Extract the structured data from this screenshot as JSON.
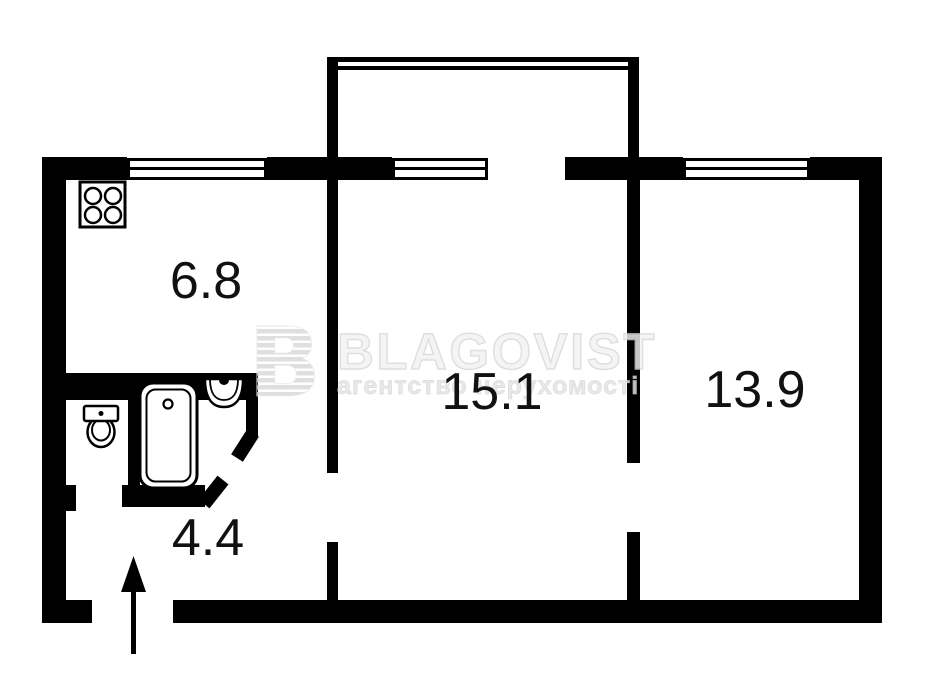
{
  "plan": {
    "background_color": "#ffffff",
    "wall_color": "#000000",
    "label_color": "#111111",
    "rooms": [
      {
        "name": "kitchen",
        "area_label": "6.8"
      },
      {
        "name": "living-room",
        "area_label": "15.1"
      },
      {
        "name": "bedroom",
        "area_label": "13.9"
      },
      {
        "name": "hallway",
        "area_label": "4.4"
      }
    ],
    "fixtures": [
      {
        "icon": "stove-icon"
      },
      {
        "icon": "toilet-icon"
      },
      {
        "icon": "bathtub-icon"
      },
      {
        "icon": "sink-icon"
      },
      {
        "icon": "entry-arrow-icon"
      },
      {
        "icon": "balcony-railing"
      },
      {
        "icon": "window-icon"
      }
    ]
  },
  "watermark": {
    "logo_letter": "B",
    "title": "BLAGOVIST",
    "subtitle": "агентство нерухомості",
    "color": "#dedede"
  }
}
